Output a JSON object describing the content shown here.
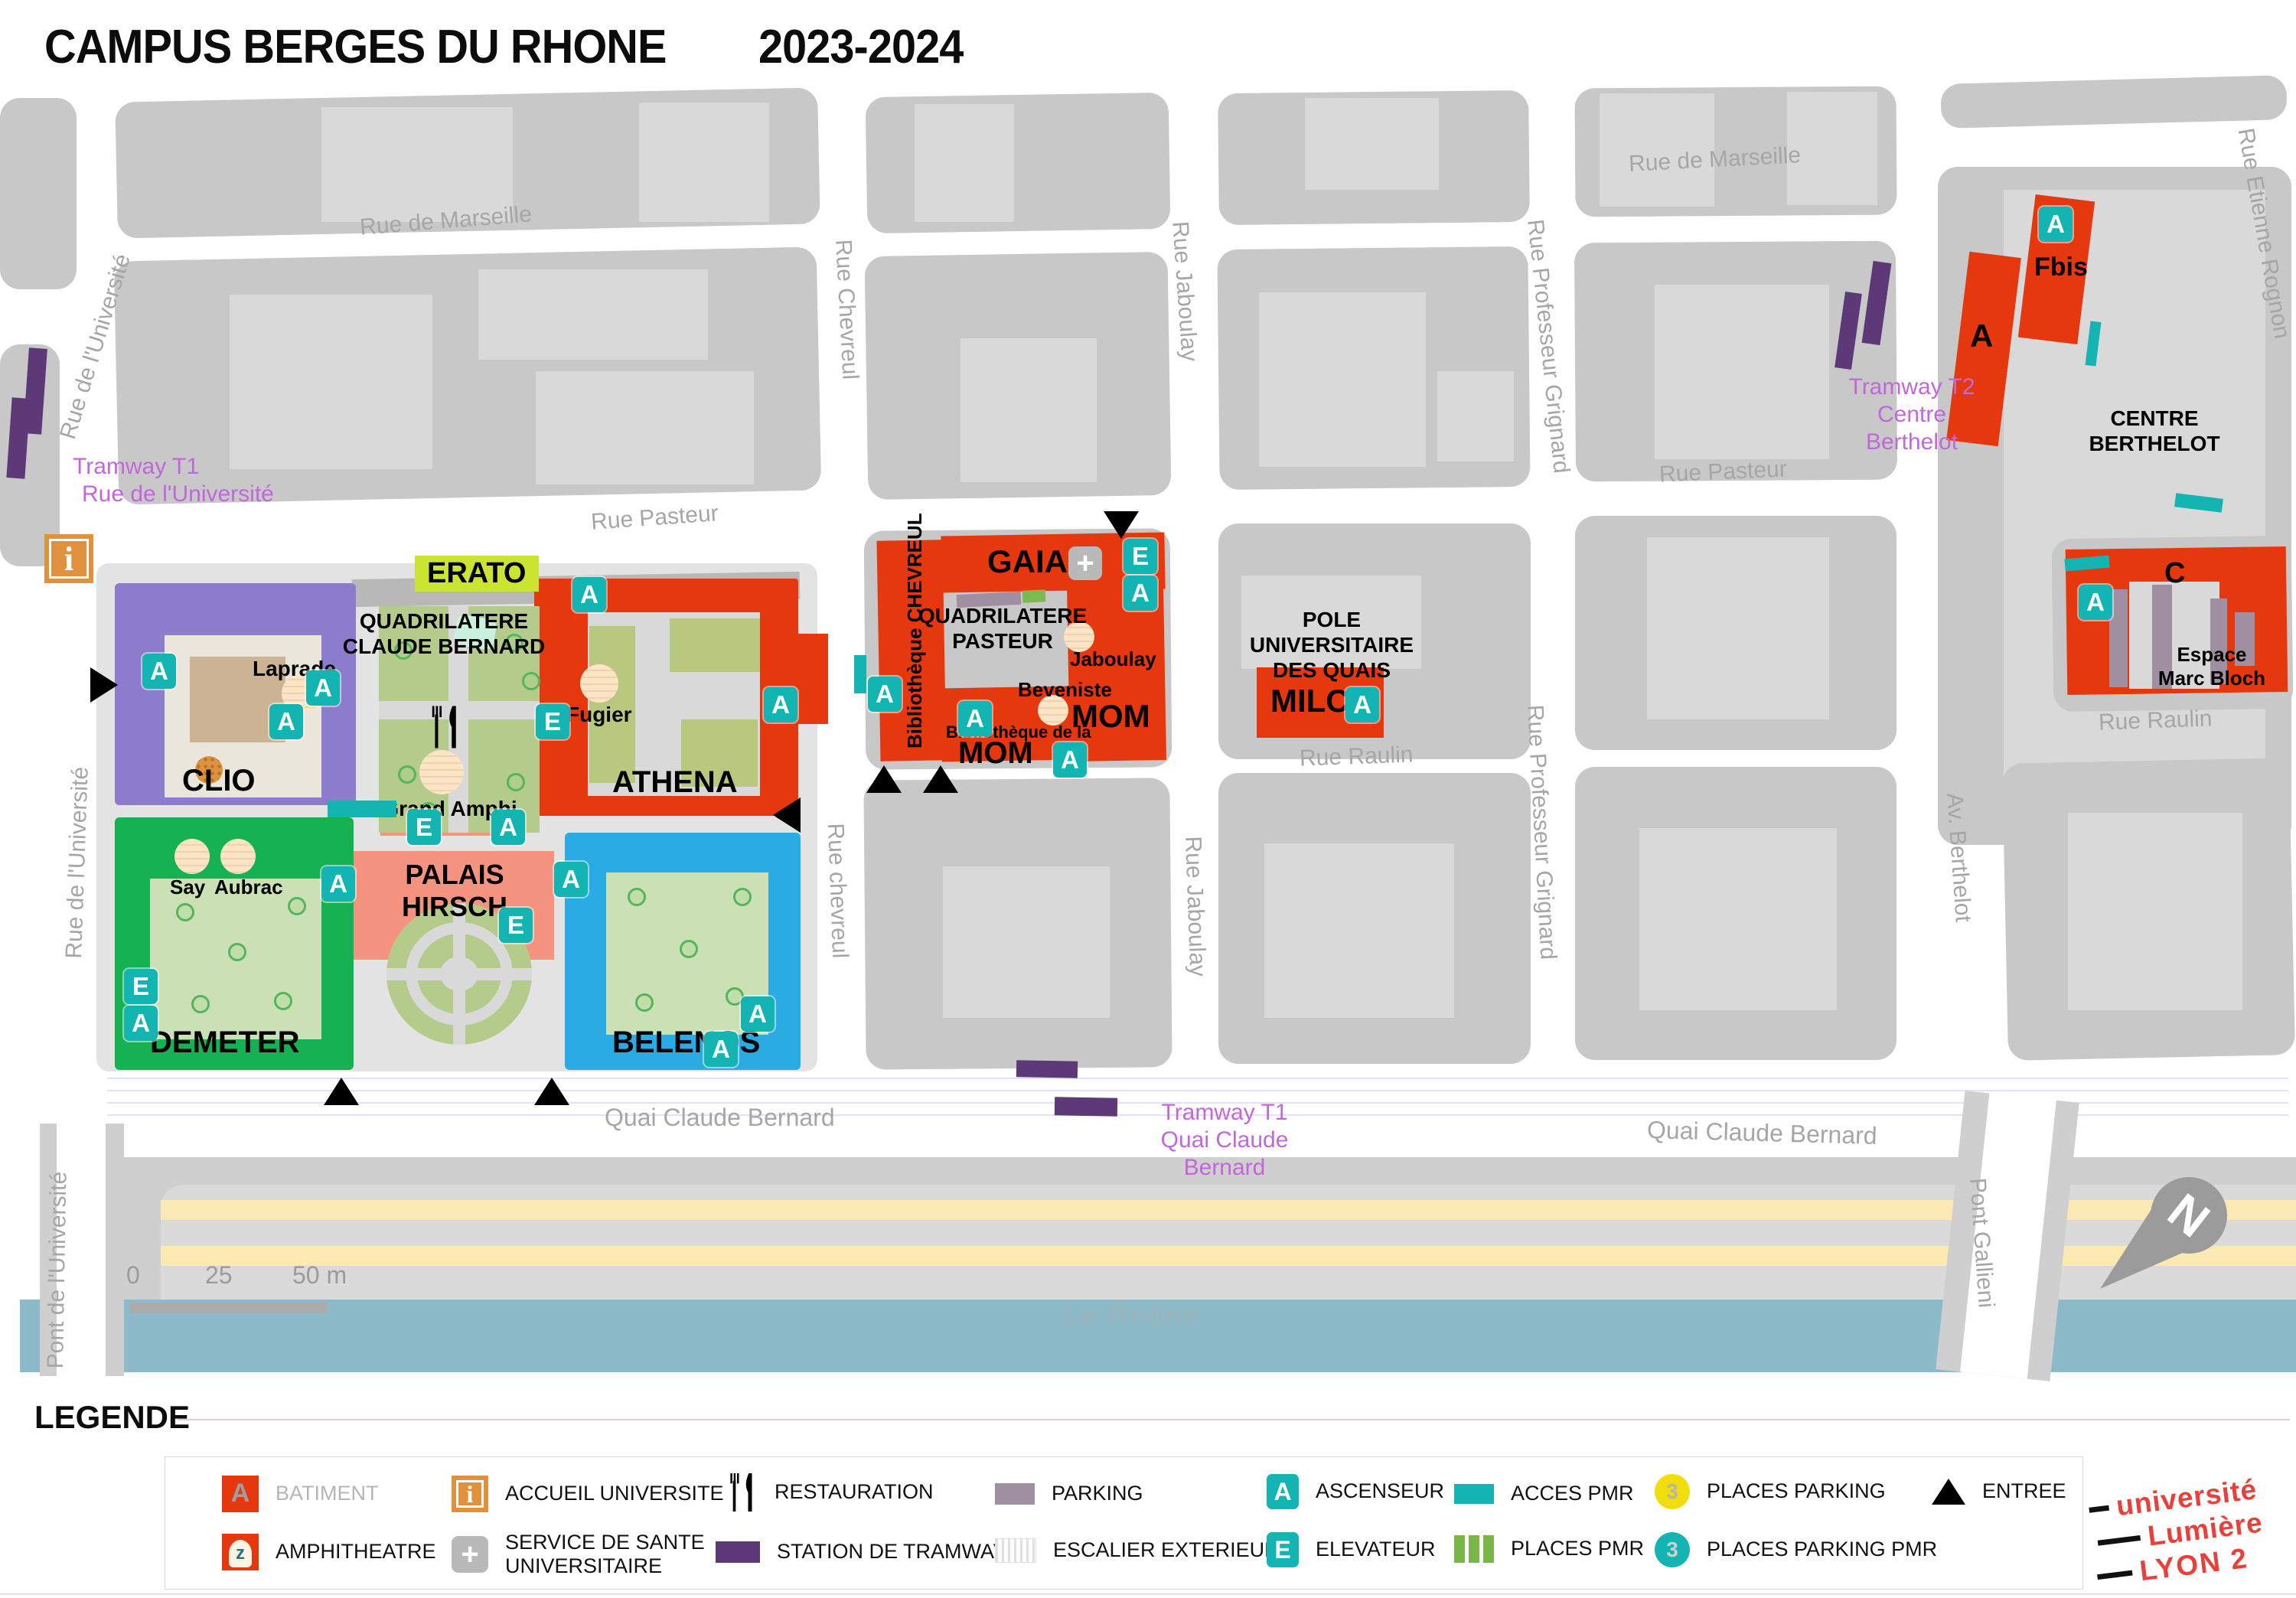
{
  "title": {
    "main": "CAMPUS BERGES DU RHONE",
    "year": "2023-2024"
  },
  "streets": {
    "marseille_left": "Rue de Marseille",
    "marseille_right": "Rue de Marseille",
    "pasteur_left": "Rue Pasteur",
    "pasteur_right": "Rue Pasteur",
    "raulin_mid": "Rue Raulin",
    "raulin_right": "Rue Raulin",
    "quai_left": "Quai Claude Bernard",
    "quai_right": "Quai Claude Bernard",
    "universite_top": "Rue de l'Université",
    "universite_bottom": "Rue de l'Université",
    "pont_universite": "Pont de l'Université",
    "chevreul_top": "Rue Chevreul",
    "chevreul_mid": "Rue chevreul",
    "jaboulay_top": "Rue Jaboulay",
    "jaboulay_mid": "Rue Jaboulay",
    "grignard_top": "Rue Professeur Grignard",
    "grignard_mid": "Rue Professeur Grignard",
    "berthelot_av": "Av. Berthelot",
    "pont_gallieni": "Pont Gallieni",
    "etienne_rognon": "Rue Etienne Rognon"
  },
  "river_label": "Le Rhône",
  "north_label": "N",
  "scale_bar": {
    "t0": "0",
    "t25": "25",
    "t50": "50 m"
  },
  "tram": {
    "t1_univ": {
      "l1": "Tramway T1",
      "l2": "Rue de l'Université"
    },
    "t2_berthelot": {
      "l1": "Tramway T2",
      "l2": "Centre",
      "l3": "Berthelot"
    },
    "t1_quai": {
      "l1": "Tramway T1",
      "l2": "Quai Claude",
      "l3": "Bernard"
    }
  },
  "buildings": {
    "clio": "CLIO",
    "erato": "ERATO",
    "quad_cb_l1": "QUADRILATERE",
    "quad_cb_l2": "CLAUDE BERNARD",
    "athena": "ATHENA",
    "palais_hirsch": "PALAIS HIRSCH",
    "demeter": "DEMETER",
    "belenos": "BELENOS",
    "gaia": "GAIA",
    "quad_pasteur_l1": "QUADRILATERE",
    "quad_pasteur_l2": "PASTEUR",
    "bib_chevreul": "Bibliothèque CHEVREUL",
    "bib_mom_l1": "Bibliothèque de la",
    "bib_mom_l2": "MOM",
    "mom": "MOM",
    "pole_l1": "POLE UNIVERSITAIRE",
    "pole_l2": "DES QUAIS",
    "milc": "MILC",
    "centre_berthelot_l1": "CENTRE",
    "centre_berthelot_l2": "BERTHELOT",
    "bat_a": "A",
    "fbis": "Fbis",
    "bat_c": "C",
    "marc_bloch_l1": "Espace",
    "marc_bloch_l2": "Marc Bloch"
  },
  "amphis": {
    "laprade": "Laprade",
    "fugier": "Fugier",
    "grand_amphi": "Grand Amphi",
    "say": "Say",
    "aubrac": "Aubrac",
    "jaboulay": "Jaboulay",
    "beveniste": "Beveniste",
    "mom": "MOM"
  },
  "badges": {
    "a": "A",
    "e": "E",
    "i": "i",
    "z": "z",
    "plus": "+"
  },
  "legend": {
    "title": "LEGENDE",
    "count3": "3",
    "items": {
      "batiment": "BATIMENT",
      "amphitheatre": "AMPHITHEATRE",
      "accueil": "ACCUEIL UNIVERSITE",
      "sante_l1": "SERVICE DE SANTE",
      "sante_l2": "UNIVERSITAIRE",
      "restauration": "RESTAURATION",
      "tramway": "STATION DE TRAMWAY",
      "parking": "PARKING",
      "escalier": "ESCALIER EXTERIEUR",
      "ascenseur": "ASCENSEUR",
      "elevateur": "ELEVATEUR",
      "acces_pmr": "ACCES PMR",
      "places_pmr": "PLACES PMR",
      "places_parking": "PLACES PARKING",
      "places_parking_pmr": "PLACES PARKING PMR",
      "entree": "ENTREE"
    }
  },
  "logo": {
    "line1": "université",
    "line2": "Lumière",
    "line3": "Lyon 2"
  },
  "colors": {
    "building_red": "#e6380e",
    "clio_purple": "#8b7ccc",
    "demeter_green": "#15b152",
    "belenos_blue": "#2aabe3",
    "palais_salmon": "#f49480",
    "teal_access": "#14b4b2",
    "tram_purple": "#5d3a77",
    "tram_label_purple": "#c168d8",
    "erato_yellow": "#cbe432",
    "accueil_orange": "#e0913d",
    "parking_mauve": "#a08fa0",
    "places_parking_yellow": "#f2dd0c",
    "places_pmr_green": "#7ab648",
    "river_blue": "#8dbac9"
  }
}
